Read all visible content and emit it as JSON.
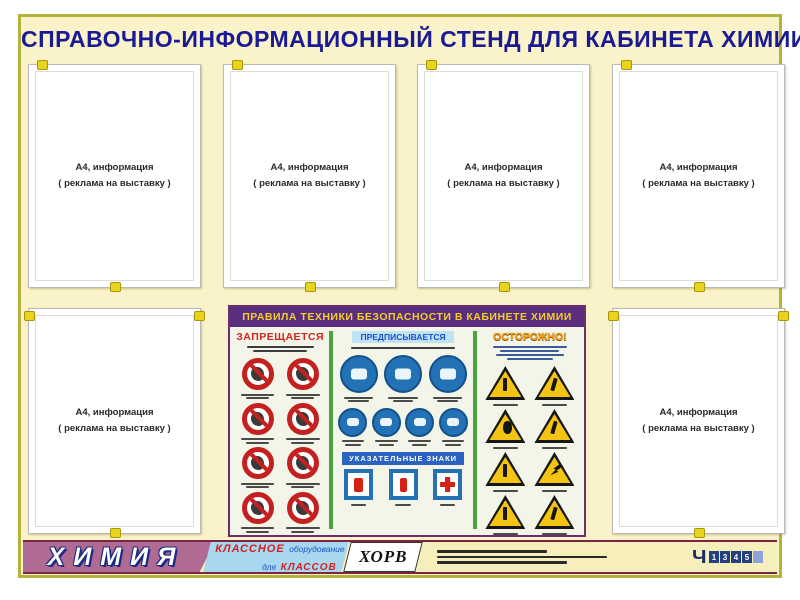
{
  "title": "СПРАВОЧНО-ИНФОРМАЦИОННЫЙ СТЕНД ДЛЯ КАБИНЕТА ХИМИИ",
  "pocket": {
    "line1": "А4, информация",
    "line2": "( реклама на выставку )"
  },
  "poster": {
    "header": "ПРАВИЛА ТЕХНИКИ БЕЗОПАСНОСТИ В КАБИНЕТЕ ХИМИИ",
    "prohibited": {
      "header": "ЗАПРЕЩАЕТСЯ",
      "count": 8
    },
    "mandatory": {
      "header": "ПРЕДПИСЫВАЕТСЯ",
      "row1": 3,
      "row2": 4
    },
    "indicating": {
      "header": "УКАЗАТЕЛЬНЫЕ ЗНАКИ",
      "count": 3
    },
    "warning": {
      "header": "ОСТОРОЖНО!",
      "count": 8
    }
  },
  "footer": {
    "subject": "ХИМИЯ",
    "brand_line1_red": "КЛАССНОЕ",
    "brand_line1_blue": "оборудование",
    "brand_line2_blue": "для",
    "brand_line2_red": "КЛАССОВ",
    "logo_text": "ХОРВ",
    "mark": "Ч",
    "digits": [
      "1",
      "3",
      "4",
      "5"
    ]
  },
  "colors": {
    "stand_bg": "#faf2c9",
    "stand_border": "#b5b13a",
    "title_navy": "#1a1a94",
    "pin_yellow": "#e9d41a",
    "poster_header_bg": "#5a2d7e",
    "poster_header_text": "#f2cf2a",
    "prohibit_red": "#c42020",
    "mandatory_blue": "#2272b5",
    "warning_yellow": "#f4c414",
    "divider_green": "#4aa33c",
    "footer_mauve": "#b06b93",
    "footer_blue": "#a8d8f0",
    "maroon_line": "#7d2540"
  }
}
